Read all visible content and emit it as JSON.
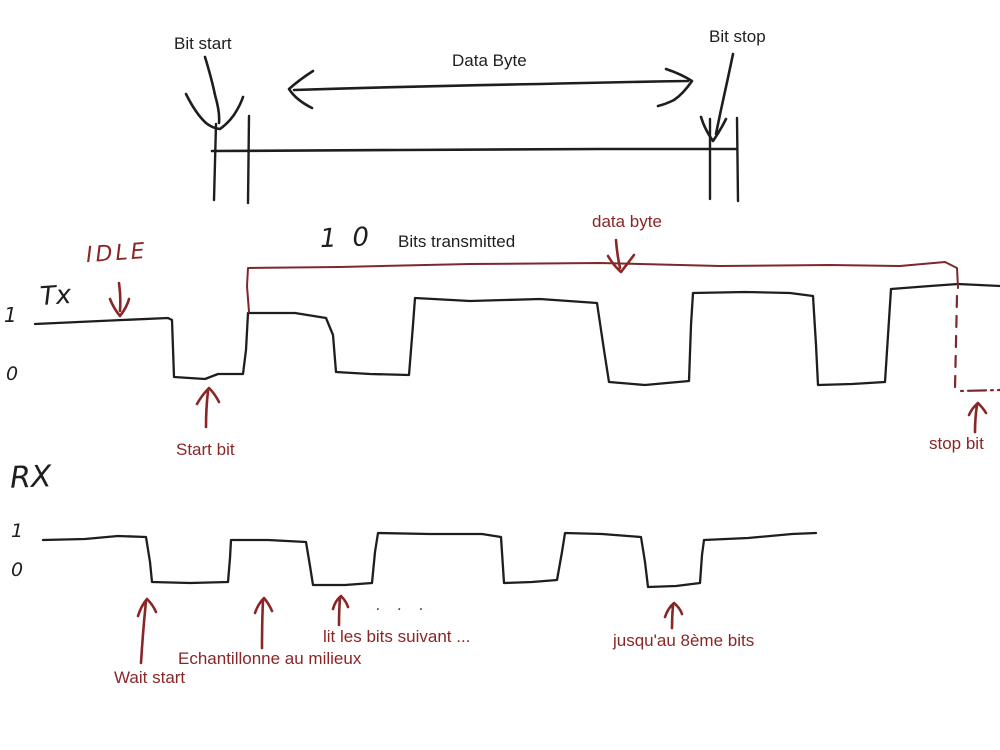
{
  "colors": {
    "ink": "#1e1e1e",
    "annotation_red": "#8a2626",
    "outline_red": "#7d282b",
    "background": "#ffffff"
  },
  "top_diagram": {
    "bit_start_label": "Bit start",
    "data_byte_label": "Data Byte",
    "bit_stop_label": "Bit stop"
  },
  "tx": {
    "idle_label": "IDLE",
    "channel_label": "Tx",
    "level_high_label": "1",
    "level_low_label": "0",
    "bits_count_handwritten": "10",
    "bits_transmitted_label": "Bits transmitted",
    "data_byte_label": "data byte",
    "start_bit_label": "Start bit",
    "stop_bit_label": "stop bit"
  },
  "rx": {
    "channel_label": "RX",
    "level_high_label": "1",
    "level_low_label": "0",
    "wait_start_label": "Wait start",
    "sample_middle_label": "Echantillonne au milieux",
    "read_next_bits_label": "lit les bits suivant ...",
    "ellipsis_handwritten": ". . .",
    "until_8th_bit_label": "jusqu'au 8ème bits"
  },
  "paths": {
    "timeline_line": "M 212 151 L 400 150 L 600 149 L 737 149",
    "timeline_tick_left_a": "M 216 124 L 214 200",
    "timeline_tick_left_b": "M 249 116 L 248 203",
    "timeline_tick_right_a": "M 710 119 L 710 199",
    "timeline_tick_right_b": "M 737 118 L 738 201",
    "bit_start_arrow": "M 205 57 Q 212 80 215 95 Q 220 112 219 123 M 186 94 Q 196 114 206 123 Q 212 128 220 129 Q 231 121 237 110 Q 241 103 243 97",
    "bit_stop_arrow": "M 733 54 Q 728 78 724 96 Q 720 114 716 134 M 701 117 Q 705 130 713 141 Q 720 131 726 119",
    "data_byte_arrow": "M 294 90 Q 420 86 540 84 Q 620 82 688 81 M 313 71 Q 299 80 289 89 Q 296 100 312 108 M 666 69 Q 681 74 692 81 Q 683 94 674 100 Q 666 104 658 106",
    "tx_waveform": "M 35 324 L 100 321 L 168 318 L 172 320 L 174 377 L 205 379 L 218 374 L 243 374 L 246 350 L 248 313 L 295 313 L 326 318 L 333 335 L 336 372 L 370 374 L 409 375 L 413 325 L 415 298 L 470 301 L 540 299 L 597 303 L 604 350 L 609 382 L 645 385 L 689 381 L 691 325 L 693 293 L 745 292 L 790 293 L 813 296 L 816 345 L 818 385 L 852 384 L 885 382 L 889 320 L 891 289 L 930 286 L 958 284 L 1000 286",
    "rx_waveform": "M 43 540 L 85 539 L 118 536 L 146 537 L 150 562 L 152 582 L 190 583 L 228 582 L 230 558 L 231 540 L 268 540 L 306 542 L 310 566 L 313 585 L 345 585 L 372 583 L 375 552 L 378 533 L 430 534 L 482 534 L 501 537 L 504 583 L 532 582 L 557 580 L 562 552 L 565 533 L 602 534 L 641 537 L 645 562 L 648 587 L 676 586 L 700 583 L 702 555 L 704 540 L 748 538 L 792 534 L 816 533",
    "data_byte_outline": "M 249 312 L 247 286 L 248 268 L 340 267 L 470 264 L 600 263 L 720 266 L 830 265 L 900 266 L 945 262 L 951 265 L 957 268 L 958 288",
    "data_byte_outline_dash_v": "M 957 296 L 955 388",
    "data_byte_outline_dash_h": "M 961 391 L 1000 390",
    "idle_arrow": "M 119 283 Q 121 297 120 311 M 110 299 Q 114 309 120 316 Q 127 307 129 299",
    "data_byte_arrow_down": "M 616 240 Q 617 254 620 268 M 608 256 Q 614 266 621 272 Q 628 263 634 255",
    "start_bit_arrow": "M 208 391 Q 206 408 206 427 M 197 404 Q 202 395 209 388 Q 215 394 219 402",
    "stop_bit_arrow": "M 977 405 Q 975 418 975 432 M 969 415 Q 972 408 978 403 Q 983 408 986 413",
    "wait_start_arrow": "M 146 601 Q 143 630 141 663 M 138 616 Q 141 606 147 599 Q 153 605 156 612",
    "sample_middle_arrow": "M 263 600 Q 262 622 262 648 M 255 613 Q 258 604 264 598 Q 269 604 272 611",
    "read_next_bits_arrow": "M 340 598 Q 339 610 339 625 M 333 609 Q 335 601 341 596 Q 346 601 348 607",
    "until_8th_bit_arrow": "M 673 605 Q 672 616 672 628 M 665 617 Q 668 608 674 603 Q 680 608 682 614"
  }
}
